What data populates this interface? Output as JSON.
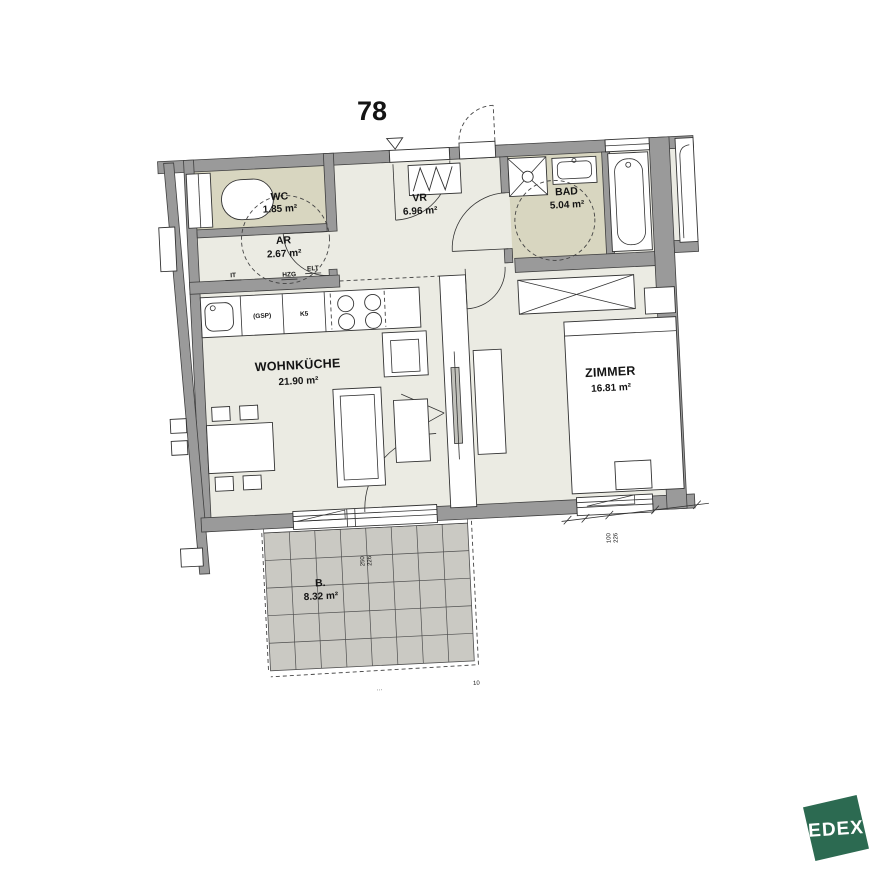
{
  "unit_number": "78",
  "rooms": {
    "wc": {
      "name": "WC",
      "area": "1.85 m²"
    },
    "ar": {
      "name": "AR",
      "area": "2.67 m²"
    },
    "vr": {
      "name": "VR",
      "area": "6.96 m²"
    },
    "bad": {
      "name": "BAD",
      "area": "5.04 m²"
    },
    "wohnkueche": {
      "name": "WOHNKÜCHE",
      "area": "21.90 m²"
    },
    "zimmer": {
      "name": "ZIMMER",
      "area": "16.81 m²"
    },
    "balkon": {
      "name": "B.",
      "area": "8.32 m²"
    }
  },
  "utility_labels": {
    "it": "IT",
    "hzg": "HZG",
    "elt": "ELT",
    "gsp": "(GSP)",
    "k5": "K5"
  },
  "dimensions": {
    "balcony_door": {
      "width": "250",
      "height": "226"
    },
    "zimmer_window": {
      "width": "100",
      "height": "226"
    },
    "balcony_edge": "10",
    "separator": "···"
  },
  "logo": {
    "text": "EDEX"
  },
  "colors": {
    "wall_gray": "#9a9a9a",
    "room_fill": "#ebebe3",
    "wet_room_fill": "#d8d6c0",
    "balcony_fill": "#cac9c3",
    "logo_green": "#2c6a51"
  }
}
